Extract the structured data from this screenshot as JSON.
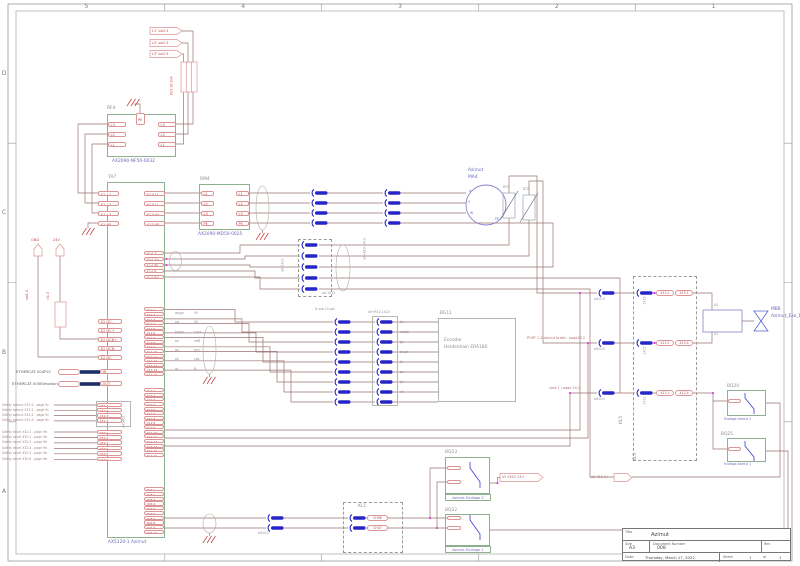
{
  "frame": {
    "columns": [
      "5",
      "4",
      "3",
      "2",
      "1"
    ],
    "rows": [
      "D",
      "C",
      "B",
      "A"
    ]
  },
  "title_block": {
    "title_label": "Title",
    "title": "Azimut",
    "size_label": "Size",
    "size": "A3",
    "doc_label": "Document Number",
    "doc": "008",
    "rev_label": "Rev",
    "date_label": "Date:",
    "date": "Thursday, March 17, 2022",
    "sheet_label": "Sheet",
    "sheet": "1",
    "of_label": "of",
    "sheet_total": "1"
  },
  "power": {
    "flags": [
      "L1' sw2.5",
      "L2' sw2.5",
      "L3' sw2.5"
    ],
    "fuse_label": "K03 16-20A",
    "rf4": {
      "ref": "RF4",
      "type": "AX2090-NF50-0032",
      "pe": "PE",
      "left_pins": [
        "L3",
        "L2",
        "L1"
      ],
      "right_pins": [
        "L3",
        "L2",
        "L1"
      ]
    },
    "rm4": {
      "ref": "RM4",
      "type": "AX2090-MD50-0025",
      "left_pins": [
        "L1",
        "L2",
        "L3",
        "PE"
      ],
      "right_pins": [
        "L1",
        "L2",
        "L3",
        "PE"
      ]
    }
  },
  "drive": {
    "ref": "TA7",
    "type": "AX5120-1 Azimut",
    "x1_pins": [
      "X1 L1",
      "X1 L2",
      "X1 L3",
      "X1 PE"
    ],
    "x13_pins": [
      "X13 U",
      "X13 V",
      "X13 W",
      "X13 PE"
    ],
    "x14_pins": [
      "X14 T-",
      "X14 T+",
      "X14 PE",
      "X14 B-",
      "X14 B+"
    ],
    "x11_pins": [
      "X11:1",
      "X11:2",
      "X11:3",
      "X11:4",
      "X11:5",
      "X11:6",
      "X11:7",
      "X11:8",
      "X11:9",
      "X11:10",
      "X11:11",
      "X11:12",
      "X11:13",
      "X11:14",
      "X11:15"
    ],
    "x12_pins": [
      "X12:1",
      "X12:2",
      "X12:3",
      "X12:4",
      "X12:5",
      "X12:6",
      "X12:7",
      "X12:8",
      "X12:9",
      "X12:10",
      "X12:11",
      "X12:12",
      "X12:13",
      "X12:14",
      "X12:15"
    ],
    "x06_pins": [
      "X06:1",
      "X06:2",
      "X06:3",
      "X06:4",
      "X06:5",
      "X06:6",
      "X06:7",
      "X06:8",
      "X06:9",
      "X06:10"
    ],
    "x2_pins": [
      "X2 DC-",
      "X2 DC+",
      "X2 DCB+",
      "X2 DCB-",
      "X2 DC"
    ],
    "x31_pins": [
      "X31:1",
      "X31:2",
      "X31:3",
      "X31:4"
    ],
    "x32_pins": [
      "X32:1",
      "X32:2",
      "X32:3",
      "X32:4",
      "X32:5",
      "X32:6"
    ],
    "in_label": "IN",
    "out_label": "OUT",
    "aux_label": "AX5801"
  },
  "supply": {
    "gnd_flag": "GND",
    "v24_flag": "24V",
    "wire1": "sw1.5",
    "wire2": "rt1.5"
  },
  "ethercat": {
    "in_ref": "ETHERCAT 004PLC",
    "out_ref": "ETHERCAT 005Elevation"
  },
  "xrefs": {
    "x31": [
      "Safety azimut X31:1 - page 9c",
      "Safety azimut X31:2 - page 9c",
      "Safety azimut X31:3 - page 9c",
      "Safety azimut X31:4 - page 9c"
    ],
    "x32": [
      "Safety decel X32:1 - page 9b",
      "Safety decel X32:2 - page 9b",
      "Safety decel X32:3 - page 9b",
      "Safety decel X32:4 - page 9b",
      "Safety decel X32:5 - page 9b",
      "Safety decel X32:6 - page 9b"
    ]
  },
  "motor": {
    "name": "Azimut",
    "ref": "MA4",
    "u": "U",
    "v": "V",
    "w": "W",
    "pe": "PE",
    "bt1": "BT1",
    "bt2": "BT2"
  },
  "cables": {
    "rm4_out": "alt-1X13",
    "motor_cable": "alt+KL9-1X13",
    "x14_cable": "alt-1X13",
    "dsub": "D sub 15 pol",
    "enc_cable": "alt+R13-1X23",
    "kl1_cable": "alt-X12"
  },
  "encoder": {
    "ref": "BG11",
    "line1": "Encoder",
    "line2": "Heidenhain ERA180",
    "core_colors": [
      "bk",
      "ws/gn",
      "gy",
      "bn/gn",
      "bl",
      "gn",
      "pk",
      "rd"
    ],
    "x11_colors": [
      "ws/gn",
      "sw",
      "bn/gn",
      "bk",
      "gn",
      "pk",
      "rd"
    ],
    "x11_signals": [
      "5V",
      "0V",
      "cos+",
      "refB",
      "sin+",
      "cos-",
      "B-"
    ]
  },
  "kl5": {
    "label": "KL5",
    "rows": [
      {
        "conn": "alt-X15",
        "plug": "1X15",
        "p1": "X15.1",
        "p2": "X15.1"
      },
      {
        "conn": "alt-X15",
        "plug": "1X15",
        "p1": "X15.1",
        "p2": "X15.4"
      },
      {
        "conn": "alt-X12",
        "plug": "1X12",
        "p1": "X12.1",
        "p2": "X12.4"
      }
    ],
    "port_text": "PORT 1.2 azimut brake - page20.2",
    "cont_text": "cont.1 / page 20.1"
  },
  "brake": {
    "a2": "A2",
    "a1": "A1",
    "ref": "MB8",
    "name": "Azimut_Exo_Brake"
  },
  "kl1": {
    "label": "KL1",
    "ch_pills": [
      "CH08",
      "CH07"
    ]
  },
  "endlage": {
    "bq23_ref": "BQ23",
    "bq23_label": "Azimut Endlage 2",
    "bq22_ref": "BQ22",
    "bq22_label": "Azimut Endlage 1",
    "bq24_ref": "BQ24",
    "bq24_label": "Endlage Azimut 2",
    "bq25_ref": "BQ25",
    "bq25_label": "Endlage Azimut 1",
    "flag_zk": "a5 ZK02 24V",
    "flag_x12": "a5 X12 A/"
  }
}
